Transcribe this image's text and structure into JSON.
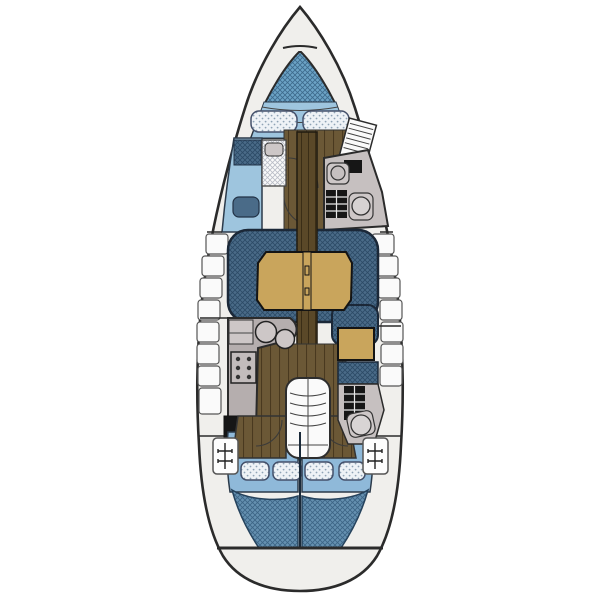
{
  "diagram": {
    "type": "boat-floor-plan",
    "subject": "sailboat-interior-layout-top-view",
    "regions": [
      {
        "id": "bow-anchor-locker"
      },
      {
        "id": "v-berth"
      },
      {
        "id": "v-berth-pillows"
      },
      {
        "id": "port-settee-forward"
      },
      {
        "id": "forward-head"
      },
      {
        "id": "hanging-locker"
      },
      {
        "id": "saloon-settee"
      },
      {
        "id": "saloon-table"
      },
      {
        "id": "mast-post-sole"
      },
      {
        "id": "galley"
      },
      {
        "id": "galley-sinks"
      },
      {
        "id": "stove"
      },
      {
        "id": "oven"
      },
      {
        "id": "chart-table"
      },
      {
        "id": "nav-seat"
      },
      {
        "id": "aft-head"
      },
      {
        "id": "toilet"
      },
      {
        "id": "companionway-steps"
      },
      {
        "id": "port-aft-cabin"
      },
      {
        "id": "starboard-aft-cabin"
      },
      {
        "id": "aft-berth-pillows"
      },
      {
        "id": "deck-cleats"
      },
      {
        "id": "transom"
      }
    ]
  },
  "colors": {
    "background": "#ffffff",
    "hull_fill": "#f0efec",
    "outline": "#2b2b2b",
    "berth_blue": "#6ca3c6",
    "berth_hatch": "#3d6a8c",
    "berth_light": "#9ec5de",
    "aft_band_blue": "#8fb9d9",
    "settee_blue": "#4a6b88",
    "settee_hatch": "#2c4a66",
    "aft_blue": "#6590b0",
    "aft_hatch": "#3c6485",
    "pillow": "#eef2f6",
    "pillow_dot": "#8fa3b5",
    "wood": "#6b5836",
    "wood_line": "#49391f",
    "wood_dark": "#5a4828",
    "wood_dark_line": "#3a2d16",
    "table_tan": "#c9a55c",
    "counter_gray": "#b5aeae",
    "counter_light": "#cdc7c7",
    "head_gray": "#c6c0c0",
    "black_fixture": "#161616",
    "white_fixture": "#fafafa",
    "white_hatch_line": "#b9bcc6",
    "seat_light_blue": "#9ec5de"
  }
}
